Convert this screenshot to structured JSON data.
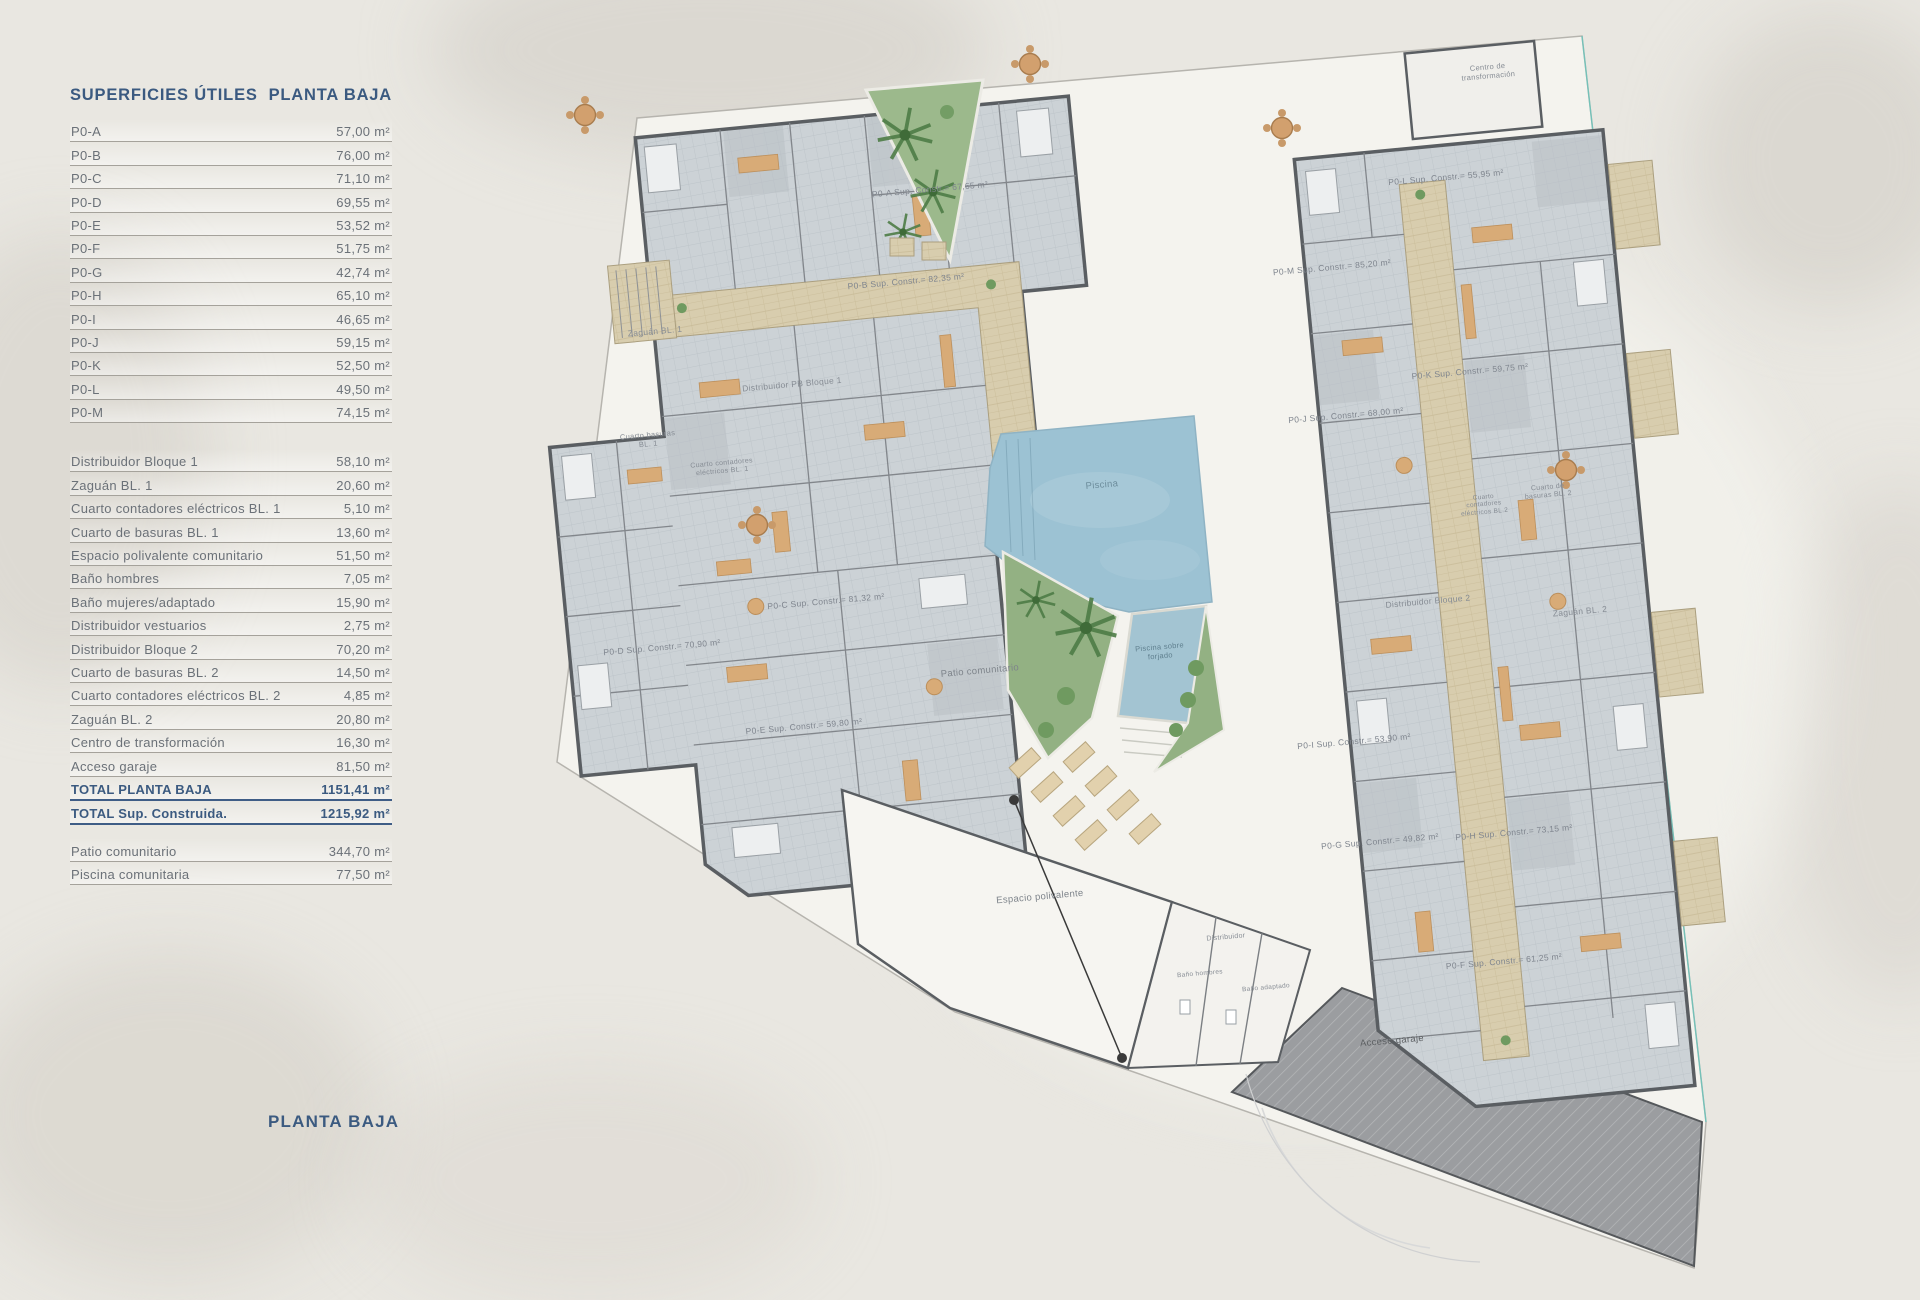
{
  "page": {
    "footer_title": "PLANTA BAJA"
  },
  "surface_table": {
    "title_left": "SUPERFICIES ÚTILES",
    "title_right": "PLANTA BAJA",
    "unit_rows": [
      {
        "label": "P0-A",
        "value": "57,00 m²"
      },
      {
        "label": "P0-B",
        "value": "76,00 m²"
      },
      {
        "label": "P0-C",
        "value": "71,10 m²"
      },
      {
        "label": "P0-D",
        "value": "69,55 m²"
      },
      {
        "label": "P0-E",
        "value": "53,52 m²"
      },
      {
        "label": "P0-F",
        "value": "51,75 m²"
      },
      {
        "label": "P0-G",
        "value": "42,74 m²"
      },
      {
        "label": "P0-H",
        "value": "65,10 m²"
      },
      {
        "label": "P0-I",
        "value": "46,65 m²"
      },
      {
        "label": "P0-J",
        "value": "59,15 m²"
      },
      {
        "label": "P0-K",
        "value": "52,50 m²"
      },
      {
        "label": "P0-L",
        "value": "49,50 m²"
      },
      {
        "label": "P0-M",
        "value": "74,15 m²"
      }
    ],
    "common_rows": [
      {
        "label": "Distribuidor Bloque 1",
        "value": "58,10 m²"
      },
      {
        "label": "Zaguán BL. 1",
        "value": "20,60 m²"
      },
      {
        "label": "Cuarto contadores eléctricos BL. 1",
        "value": "5,10 m²"
      },
      {
        "label": "Cuarto de basuras BL. 1",
        "value": "13,60 m²"
      },
      {
        "label": "Espacio polivalente comunitario",
        "value": "51,50 m²"
      },
      {
        "label": "Baño hombres",
        "value": "7,05 m²"
      },
      {
        "label": "Baño mujeres/adaptado",
        "value": "15,90 m²"
      },
      {
        "label": "Distribuidor vestuarios",
        "value": "2,75 m²"
      },
      {
        "label": "Distribuidor Bloque 2",
        "value": "70,20 m²"
      },
      {
        "label": "Cuarto de basuras BL. 2",
        "value": "14,50 m²"
      },
      {
        "label": "Cuarto contadores eléctricos BL. 2",
        "value": "4,85 m²"
      },
      {
        "label": "Zaguán BL. 2",
        "value": "20,80 m²"
      },
      {
        "label": "Centro de transformación",
        "value": "16,30 m²"
      },
      {
        "label": "Acceso garaje",
        "value": "81,50 m²"
      },
      {
        "label": "TOTAL PLANTA BAJA",
        "value": "1151,41 m²",
        "cls": "total"
      },
      {
        "label": "TOTAL Sup. Construida.",
        "value": "1215,92 m²",
        "cls": "total"
      }
    ],
    "outdoor_rows": [
      {
        "label": "Patio comunitario",
        "value": "344,70 m²"
      },
      {
        "label": "Piscina comunitaria",
        "value": "77,50 m²"
      }
    ]
  },
  "plan": {
    "labels": {
      "zaguan_bl1": "Zaguán BL. 1",
      "distribuidor_pb_bloque1": "Distribuidor PB Bloque 1",
      "cuarto_basuras_bl1": "Cuarto basuras BL. 1",
      "cuarto_contadores_bl1": "Cuarto contadores eléctricos BL. 1",
      "centro_transformacion": "Centro de transformación",
      "piscina": "Piscina",
      "piscina_sobre_forjado": "Piscina sobre forjado",
      "patio_comunitario": "Patio comunitario",
      "espacio_polivalente": "Espacio polivalente",
      "distribuidor": "Distribuidor",
      "bano_hombres": "Baño hombres",
      "bano_adaptado": "Baño adaptado",
      "acceso_garaje": "Acceso garaje",
      "distribuidor_bloque2": "Distribuidor Bloque 2",
      "zaguan_bl2": "Zaguán BL. 2",
      "cuarto_basuras_bl2": "Cuarto de basuras BL. 2",
      "cuarto_contadores_bl2": "Cuarto contadores eléctricos BL.2"
    },
    "apartments": [
      "P0-A Sup. Constr.= 67,65 m²",
      "P0-B Sup. Constr.= 82,35 m²",
      "P0-C Sup. Constr.= 81,32 m²",
      "P0-D Sup. Constr.= 70,90 m²",
      "P0-E Sup. Constr.= 59,80 m²",
      "P0-L Sup. Constr.= 55,95 m²",
      "P0-M Sup. Constr.= 85,20 m²",
      "P0-K Sup. Constr.= 59,75 m²",
      "P0-J Sup. Constr.= 68,00 m²",
      "P0-I Sup. Constr.= 53,90 m²",
      "P0-G Sup. Constr.= 49,82 m²",
      "P0-H Sup. Constr.= 73,15 m²",
      "P0-F Sup. Constr.= 61,25 m²"
    ],
    "colors": {
      "accent_blue": "#3b5a80",
      "pool_blue": "#9cc2d3",
      "garden_green": "#9cb98c",
      "floor_gray": "#ccd2d6",
      "corridor_tan": "#d8cdae",
      "wall_gray": "#5a5e62"
    }
  }
}
